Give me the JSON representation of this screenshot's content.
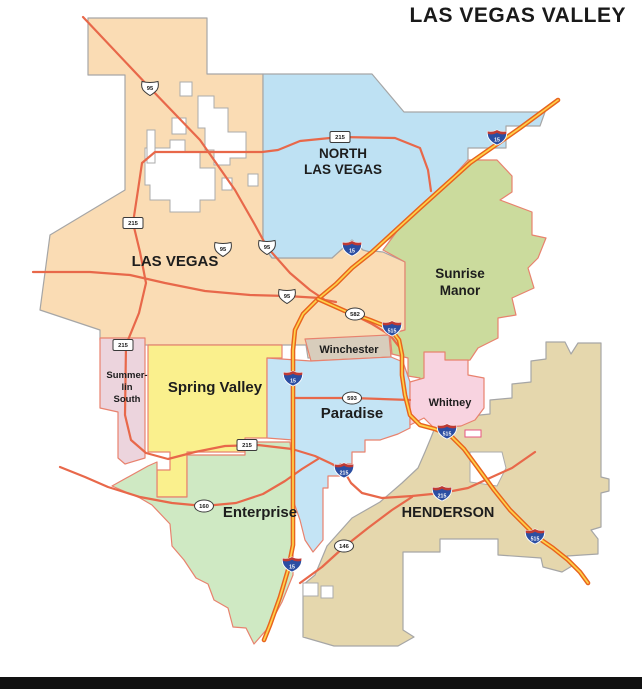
{
  "title": "LAS VEGAS VALLEY",
  "footer_bar_color": "#111111",
  "map": {
    "width": 642,
    "height": 689,
    "background": "#ffffff",
    "regions": [
      {
        "id": "las-vegas",
        "color": "#FADCB4",
        "stroke": "#A6A6A6",
        "points": "88,18 207,18 207,74 263,74 263,246 272,258 332,258 352,240 363,250 383,252 405,262 405,330 390,334 392,354 308,358 306,345 143,345 143,340 100,340 100,330 88,326 40,310 50,235 125,190 125,75 88,75",
        "label": {
          "lines": [
            "LAS VEGAS"
          ],
          "x": 175,
          "y": 266,
          "size": 15,
          "lineh": 17
        }
      },
      {
        "id": "north-las-vegas",
        "color": "#BEE1F3",
        "stroke": "#A6A6A6",
        "points": "263,74 372,74 404,112 545,112 540,126 506,126 506,148 468,148 468,162 445,188 420,210 395,235 370,252 363,250 352,240 332,258 272,258 263,246",
        "label": {
          "lines": [
            "NORTH",
            "LAS VEGAS"
          ],
          "x": 343,
          "y": 158,
          "size": 13.5,
          "lineh": 16
        }
      },
      {
        "id": "henderson",
        "color": "#E5D7AD",
        "stroke": "#A6A6A6",
        "points": "461,424 470,416 490,414 490,400 512,398 512,384 531,382 531,361 546,359 546,342 565,342 571,354 578,343 601,343 601,477 609,479 609,491 601,493 601,527 591,530 598,539 598,554 567,556 572,566 562,572 543,567 541,558 498,555 498,539 440,539 440,552 403,552 403,630 414,637 398,646 334,646 303,637 303,585 315,575 327,546 352,518 380,502 402,483 418,468 425,452 430,440 434,430",
        "label": {
          "lines": [
            "HENDERSON"
          ],
          "x": 448,
          "y": 517,
          "size": 14.5,
          "lineh": 16
        }
      },
      {
        "id": "sunrise-manor",
        "color": "#CBDB9D",
        "stroke": "#E8826E",
        "points": "468,160 497,160 512,176 512,192 500,200 532,212 532,235 546,238 538,258 528,268 534,288 512,298 516,315 498,318 498,338 478,348 470,360 455,362 455,372 433,372 433,392 420,390 420,378 408,376 408,358 392,354 390,334 405,330 405,262 383,250 398,230 420,208 445,185",
        "label": {
          "lines": [
            "Sunrise",
            "Manor"
          ],
          "x": 460,
          "y": 278,
          "size": 13.5,
          "lineh": 17
        }
      },
      {
        "id": "winchester",
        "color": "#D8CDBC",
        "stroke": "#E8826E",
        "points": "305,339 389,335 391,357 311,361",
        "label": {
          "lines": [
            "Winchester"
          ],
          "x": 349,
          "y": 353,
          "size": 11,
          "lineh": 12
        }
      },
      {
        "id": "summerlin-south",
        "color": "#ECD4DD",
        "stroke": "#E8826E",
        "points": "100,338 145,338 145,458 125,464 118,458 118,412 100,408",
        "label": {
          "lines": [
            "Summer-",
            "lin",
            "South"
          ],
          "x": 127,
          "y": 378,
          "size": 9.5,
          "lineh": 12
        }
      },
      {
        "id": "spring-valley",
        "color": "#FAF08D",
        "stroke": "#E8826E",
        "points": "148,345 282,345 282,358 267,358 267,438 245,438 245,452 187,452 187,497 157,497 157,470 170,470 170,452 148,452",
        "label": {
          "lines": [
            "Spring Valley"
          ],
          "x": 215,
          "y": 392,
          "size": 15,
          "lineh": 17
        }
      },
      {
        "id": "enterprise",
        "color": "#CFE9C3",
        "stroke": "#E8826E",
        "points": "112,486 148,466 157,462 157,497 187,497 187,455 245,455 245,442 290,442 293,470 293,575 282,602 268,628 254,644 246,628 233,627 228,608 214,600 208,584 196,578 184,560 172,546 170,524 152,505 140,498",
        "label": {
          "lines": [
            "Enterprise"
          ],
          "x": 260,
          "y": 517,
          "size": 15,
          "lineh": 17
        }
      },
      {
        "id": "paradise",
        "color": "#C4E4F5",
        "stroke": "#E8826E",
        "points": "267,358 311,361 391,357 403,362 410,382 410,428 398,434 380,440 365,440 365,452 352,452 352,464 340,464 340,476 328,476 328,488 323,488 323,540 313,552 305,540 300,520 293,500 293,440 267,438",
        "label": {
          "lines": [
            "Paradise"
          ],
          "x": 352,
          "y": 418,
          "size": 15,
          "lineh": 17
        }
      },
      {
        "id": "whitney",
        "color": "#F8D3E0",
        "stroke": "#E8826E",
        "points": "424,352 445,352 445,360 468,360 468,375 484,378 484,408 475,420 461,426 434,428 424,418 410,425 410,382 424,378",
        "label": {
          "lines": [
            "Whitney"
          ],
          "x": 450,
          "y": 406,
          "size": 11,
          "lineh": 12
        }
      }
    ],
    "holes": [
      {
        "id": "lv-hole-1",
        "stroke": "#ABABAB",
        "points": "145,148 170,148 170,140 185,140 185,152 200,152 200,168 215,168 215,200 200,200 200,212 170,212 170,200 150,200 150,185 145,185"
      },
      {
        "id": "lv-hole-2",
        "stroke": "#ABABAB",
        "points": "198,96 214,96 214,108 228,108 228,132 246,132 246,158 230,158 230,165 214,165 214,150 205,150 205,128 198,128"
      },
      {
        "id": "lv-hole-3",
        "stroke": "#ABABAB",
        "points": "180,82 192,82 192,96 180,96"
      },
      {
        "id": "lv-hole-4",
        "stroke": "#ABABAB",
        "points": "172,118 186,118 186,134 172,134"
      },
      {
        "id": "lv-hole-5",
        "stroke": "#ABABAB",
        "points": "147,130 155,130 155,163 147,163"
      },
      {
        "id": "lv-hole-6",
        "stroke": "#ABABAB",
        "points": "222,178 232,178 232,190 222,190"
      },
      {
        "id": "lv-hole-7",
        "stroke": "#ABABAB",
        "points": "248,174 258,174 258,186 248,186"
      },
      {
        "id": "hen-hole-1",
        "stroke": "#ABABAB",
        "points": "470,452 502,452 506,468 497,486 470,482"
      },
      {
        "id": "hen-hole-2",
        "stroke": "#ABABAB",
        "points": "303,583 318,583 318,596 303,596"
      },
      {
        "id": "hen-hole-3",
        "stroke": "#ABABAB",
        "points": "321,586 333,586 333,598 321,598"
      },
      {
        "id": "pink-enclave",
        "stroke": "#E75480",
        "points": "465,430 481,430 481,437 465,437"
      }
    ],
    "road_styles": {
      "minor": {
        "color": "#E8684A",
        "width": 2.2
      },
      "interstate": {
        "casing": "#E8641E",
        "casing_width": 4.6,
        "center": "#FFD24A",
        "center_width": 1.7
      }
    },
    "roads": [
      {
        "id": "us95-diagonal",
        "style": "minor",
        "points": "83,17 150,88 200,140 235,190 255,225 267,247 290,273 310,290 325,300 336,302"
      },
      {
        "id": "lv-east-west-road",
        "style": "minor",
        "points": "33,272 90,272 130,275 165,283 205,291 250,295 287,296 320,298"
      },
      {
        "id": "cc215-beltway",
        "style": "minor",
        "points": "431,191 428,170 420,148 395,138 340,137 300,141 278,150 262,152 200,152 155,152 142,163 138,190 133,223 140,252 146,283 139,313 126,345 125,415 131,440 146,453 168,459 195,452 225,446 258,445 292,449 315,456 332,464 344,471 351,483 362,493 382,498 412,496 442,493 468,488 492,477 512,468 535,452"
      },
      {
        "id": "sr160",
        "style": "minor",
        "points": "60,467 85,477 108,487 140,497 172,503 204,506 236,503 263,494 285,481 302,469 318,459"
      },
      {
        "id": "sr146",
        "style": "minor",
        "points": "300,583 322,567 344,547 368,528 392,510 412,497"
      },
      {
        "id": "sr593",
        "style": "minor",
        "points": "293,398 352,398 410,400"
      },
      {
        "id": "sr582",
        "style": "minor",
        "points": "322,300 350,313 372,324 390,335 400,348 403,362"
      },
      {
        "id": "i15",
        "style": "interstate",
        "points": "558,100 520,128 470,163 420,208 372,252 352,268 336,284 318,299 303,314 295,330 293,350 293,440 293,545 288,570 280,597 270,625 264,640"
      },
      {
        "id": "i515",
        "style": "interstate",
        "points": "318,299 345,311 370,320 390,328 399,340 402,355 402,375 405,395 410,415 420,425 435,429 450,435 464,449 478,468 494,490 510,510 524,524 537,537 553,548 568,560 580,572 588,583"
      }
    ],
    "shield_colors": {
      "interstate_blue": "#2B4EA2",
      "interstate_red": "#BE3A34",
      "outline": "#3a3a3a",
      "fill": "#ffffff",
      "text_dark": "#1a1a1a",
      "text_light": "#ffffff"
    },
    "shields": [
      {
        "type": "us",
        "label": "95",
        "x": 150,
        "y": 88
      },
      {
        "type": "us",
        "label": "95",
        "x": 223,
        "y": 249
      },
      {
        "type": "us",
        "label": "95",
        "x": 267,
        "y": 247
      },
      {
        "type": "us",
        "label": "95",
        "x": 287,
        "y": 296
      },
      {
        "type": "rect",
        "label": "215",
        "x": 133,
        "y": 223
      },
      {
        "type": "rect",
        "label": "215",
        "x": 340,
        "y": 137
      },
      {
        "type": "rect",
        "label": "215",
        "x": 123,
        "y": 345
      },
      {
        "type": "rect",
        "label": "215",
        "x": 247,
        "y": 445
      },
      {
        "type": "oval",
        "label": "582",
        "x": 355,
        "y": 314
      },
      {
        "type": "oval",
        "label": "593",
        "x": 352,
        "y": 398
      },
      {
        "type": "oval",
        "label": "160",
        "x": 204,
        "y": 506
      },
      {
        "type": "oval",
        "label": "146",
        "x": 344,
        "y": 546
      },
      {
        "type": "interstate",
        "label": "15",
        "x": 497,
        "y": 137
      },
      {
        "type": "interstate",
        "label": "15",
        "x": 352,
        "y": 248
      },
      {
        "type": "interstate",
        "label": "15",
        "x": 293,
        "y": 378
      },
      {
        "type": "interstate",
        "label": "15",
        "x": 292,
        "y": 564
      },
      {
        "type": "interstate",
        "label": "515",
        "x": 392,
        "y": 328
      },
      {
        "type": "interstate",
        "label": "515",
        "x": 447,
        "y": 431
      },
      {
        "type": "interstate",
        "label": "515",
        "x": 535,
        "y": 536
      },
      {
        "type": "interstate",
        "label": "215",
        "x": 344,
        "y": 470
      },
      {
        "type": "interstate",
        "label": "215",
        "x": 442,
        "y": 493
      }
    ]
  }
}
